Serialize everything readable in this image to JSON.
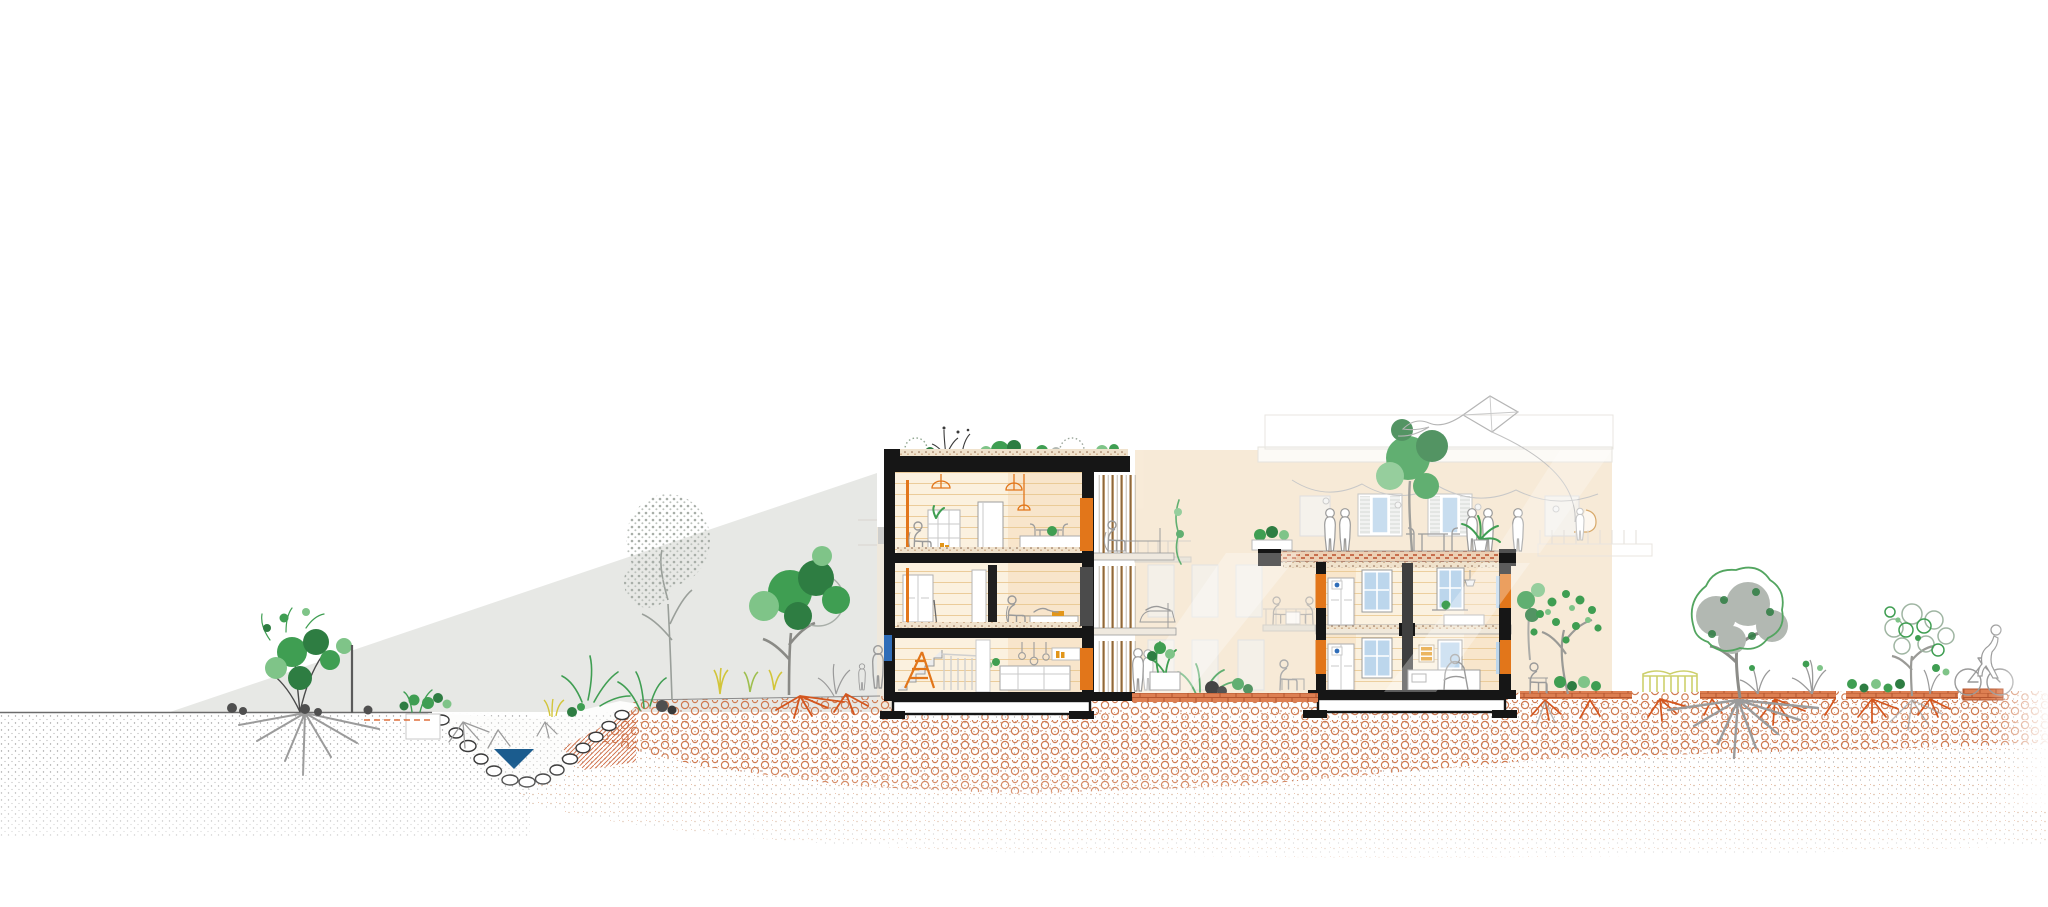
{
  "image": {
    "kind": "architectural-section-illustration",
    "width_px": 2048,
    "height_px": 907,
    "visible_text": "none"
  },
  "palette": {
    "paper_white": "#ffffff",
    "hill_grey": "#e7e8e5",
    "ink_black": "#161616",
    "structure_orange": "#e2761a",
    "louver_tan": "#a87a44",
    "wall_cream": "#fbf1df",
    "wall_peach": "#f6e0c2",
    "bg_building_peach": "#f6e6cf",
    "plank_orange": "#e8c68e",
    "soil_orange": "#cf7a50",
    "soil_brick": "#b4552f",
    "walkway_brick": "#dd7f52",
    "root_orange": "#d4561e",
    "root_grey": "#9b9b9b",
    "foliage_green": "#3f9e52",
    "foliage_green_dark": "#2e7d42",
    "foliage_green_light": "#7fc488",
    "foliage_grey": "#b2b8b2",
    "water_blue": "#1b5c8e",
    "glass_blue": "#bcd6ec",
    "frame_blue": "#2f6db8",
    "figure_grey": "#9a9a9a",
    "fence_yellow": "#cdd06c",
    "grass_yellow": "#d2c53a"
  },
  "scene": {
    "sky": {
      "element": "empty-white-sky"
    },
    "hillside": {
      "element": "grey-slope-wedge",
      "color_key": "hill_grey"
    },
    "pond": {
      "element": "stone-lined-bioswale",
      "water_color_key": "water_blue",
      "bank_hatch_color_key": "soil_orange"
    },
    "left_building": {
      "element": "sectioned-building-left",
      "storeys": 3,
      "roof": "planted-green-roof",
      "structure_color_key": "structure_orange",
      "balconies": "louvered",
      "ground_floor": [
        "stair",
        "orange-stepladder",
        "kitchen-island",
        "pendant-lights"
      ],
      "middle_floor": [
        "wardrobe",
        "desk-person",
        "daybed"
      ],
      "top_floor": [
        "armchair-person",
        "shelving",
        "plants",
        "pendant-lamps"
      ]
    },
    "right_building": {
      "element": "sectioned-building-right",
      "storeys": 2,
      "roof": "paved-roof-terrace",
      "terrace": [
        "people",
        "table-and-chairs",
        "potted-plant",
        "planter-boxes"
      ],
      "rooms": [
        "wardrobes",
        "blue-windows",
        "beds",
        "person-on-bed"
      ]
    },
    "background_building": {
      "element": "faded-courtyard-elevation",
      "features": [
        "shuttered-windows",
        "string-lights",
        "balconies-with-diners",
        "terrace-tree",
        "vines"
      ]
    },
    "kite": {
      "element": "kite-with-tail-and-string",
      "held_by": "child-on-terrace"
    },
    "landscape_left": [
      "ground-shrub-with-grey-roots",
      "marker-pole",
      "dashed-irrigation-line",
      "bare-stippled-tree",
      "green-tree",
      "yellow-grasses",
      "gardener-figures"
    ],
    "landscape_right": [
      "green-leafed-tree",
      "bench-sitter",
      "yellow-green-fence",
      "large-tree-with-grey-root-ball",
      "orchard-outline-tree",
      "shrubs-with-orange-roots",
      "cyclist",
      "brick-path-segment"
    ],
    "ground": {
      "upper_band": "orange-floral-hatch-soil",
      "lower_band": "fading-sand-stipple",
      "left_band": "grey-stipple"
    }
  }
}
